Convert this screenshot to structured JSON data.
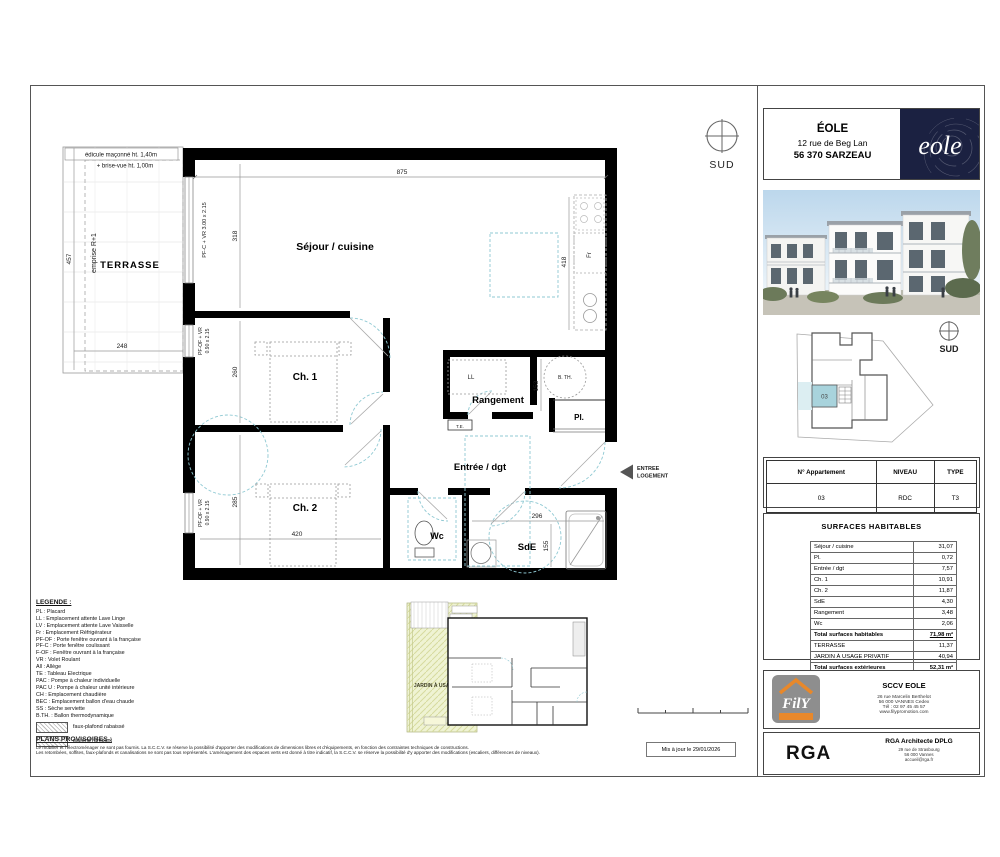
{
  "header": {
    "project": "ÉOLE",
    "address": "12 rue de Beg Lan",
    "city": "56 370 SARZEAU",
    "logo": "eole"
  },
  "compass": {
    "top": "SUD",
    "site": "SUD"
  },
  "site_plan": {
    "unit": "03"
  },
  "apartment_table": {
    "col1": "N° Appartement",
    "col2": "NIVEAU",
    "col3": "TYPE",
    "val1": "03",
    "val2": "RDC",
    "val3": "T3"
  },
  "surfaces": {
    "title": "SURFACES HABITABLES",
    "rows": [
      [
        "Séjour / cuisine",
        "31,07"
      ],
      [
        "Pl.",
        "0,72"
      ],
      [
        "Entrée / dgt",
        "7,57"
      ],
      [
        "Ch. 1",
        "10,91"
      ],
      [
        "Ch. 2",
        "11,87"
      ],
      [
        "SdE",
        "4,30"
      ],
      [
        "Rangement",
        "3,48"
      ],
      [
        "Wc",
        "2,06"
      ]
    ],
    "total_hab_label": "Total surfaces habitables",
    "total_hab_value": "71,98 m²",
    "ext_rows": [
      [
        "TERRASSE",
        "11,37"
      ],
      [
        "JARDIN À USAGE PRIVATIF",
        "40,94"
      ]
    ],
    "total_ext_label": "Total surfaces extérieures",
    "total_ext_value": "52,31 m²"
  },
  "plan": {
    "terrasse": "TERRASSE",
    "edicule": "édicule maçonné  ht. 1,40m",
    "brise_vue": "+ brise-vue ht. 1,00m",
    "emprise": "emprise R+1",
    "sejour": "Séjour / cuisine",
    "ch1": "Ch. 1",
    "ch2": "Ch. 2",
    "rangement": "Rangement",
    "entree": "Entrée / dgt",
    "wc": "Wc",
    "sde": "SdE",
    "pl": "Pl.",
    "ll": "LL",
    "bth": "B. TH.",
    "te": "T.E.",
    "fr": "Fr",
    "win_pfc": "PF-C + VR 3.00 x 2.15",
    "win_pfof1": "PF-OF + VR",
    "win_pfof2": "0.90 x 2.15",
    "entree_l1": "ENTREE",
    "entree_l2": "LOGEMENT",
    "d875": "875",
    "d318": "318",
    "d418": "418",
    "d457": "457",
    "d248": "248",
    "d260": "260",
    "d285": "285",
    "d420": "420",
    "d153": "153",
    "d296": "296",
    "d155": "155"
  },
  "inset": {
    "jardin": "JARDIN À USAGE PRIVATIF"
  },
  "legend": {
    "title": "LEGENDE :",
    "items": [
      "PL : Placard",
      "LL : Emplacement attente Lave Linge",
      "LV : Emplacement attente Lave Vaisselle",
      "Fr : Emplacement Réfrigérateur",
      "PF-OF : Porte fenêtre ouvrant à la française",
      "PF-C : Porte fenêtre coulissant",
      "F-OF : Fenêtre ouvrant à la française",
      "VR : Volet Roulant",
      "All : Allège",
      "TE : Tableau Electrique",
      "PAC : Pompe à chaleur individuelle",
      "PAC U : Pompe à chaleur unité intérieure",
      "CH : Emplacement chaudière",
      "BEC : Emplacement ballon d'eau chaude",
      "SS : Sèche serviette",
      "B.TH. : Ballon thermodynamique"
    ],
    "hatch1": "faux-plafond rabaissé",
    "hatch2": "plafond rampant"
  },
  "provisoires": {
    "title": "PLANS PROVISOIRES :",
    "line1": "Le mobilier et l'électroménager ne sont pas fournis. La S.C.C.V. se réserve la possibilité d'apporter des modifications de dimensions libres et d'équipements, en fonction des contraintes techniques de constructions.",
    "line2": "Les retombées, soffites, faux-plafonds et canalisations ne sont pas tous représentés. L'aménagement des espaces verts est donné à titre indicatif, la S.C.C.V. se réserve la possibilité d'y apporter des modifications (escaliers, différences de niveaux)."
  },
  "updated": "Mis à jour le 29/01/2026",
  "fily": {
    "name": "FilY",
    "company": "SCCV EOLE",
    "addr1": "26 rue Marcelin Berthelot",
    "addr2": "56 000 VANNES Cedex",
    "addr3": "Tél : 02 97 45 45 57",
    "addr4": "www.filypromotion.com"
  },
  "rga": {
    "logo": "RGA",
    "name": "RGA Architecte DPLG",
    "addr1": "29 rue de Strasbourg",
    "addr2": "56 000 Vannes",
    "addr3": "accueil@rga.fr"
  },
  "colors": {
    "wall": "#000000",
    "tech_dash": "#8fc9d3",
    "highlight_unit": "#a8d3dc",
    "jardin": "#eff3d3",
    "logo_bg": "#1b2141",
    "accent_orange": "#e8882a"
  }
}
